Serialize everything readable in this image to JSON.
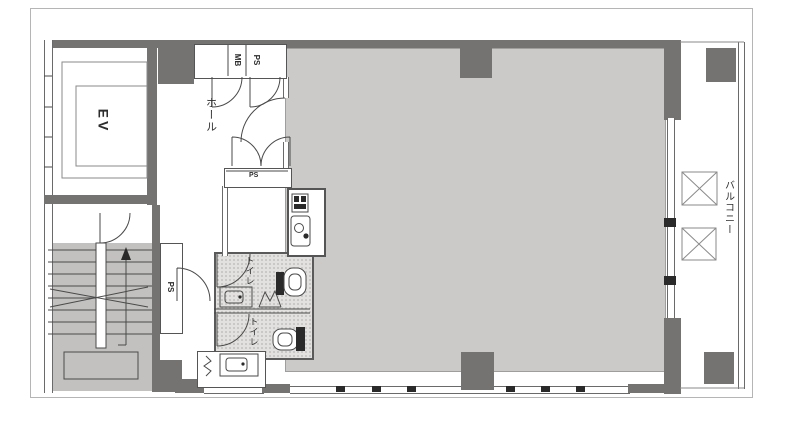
{
  "title": "floor-plan",
  "labels": {
    "elevator": "EV",
    "meter_box": "MB",
    "pipe_shaft_top": "PS",
    "hall": "ホール",
    "pipe_shaft_hall": "PS",
    "toilet_upper": "トイレ",
    "toilet_lower": "トイレ",
    "pipe_shaft_stair": "PS",
    "balcony": "バルコニー"
  },
  "colors": {
    "wall": "#757371",
    "room-fill": "#cbcac8",
    "stair-fill": "#c2c1bf",
    "tile-fill": "#e2e1df",
    "line": "#4a4a4a",
    "frame": "#b5b5b5",
    "background": "#ffffff"
  }
}
